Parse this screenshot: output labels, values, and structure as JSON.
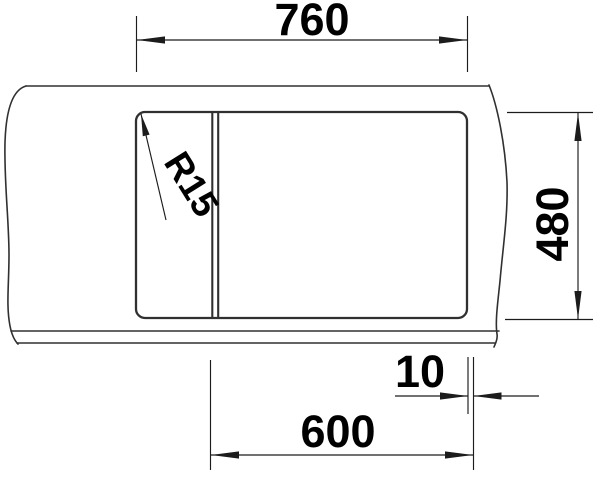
{
  "drawing": {
    "type": "technical-dimension-drawing",
    "subject": "sink cut-out top view with break lines",
    "labels": {
      "width_top": "760",
      "depth_right": "480",
      "cabinet_width": "600",
      "edge_offset": "10",
      "corner_radius": "R15"
    },
    "colors": {
      "background": "#ffffff",
      "outline": "#303030",
      "dimension": "#1c1c1c",
      "text": "#000000"
    }
  }
}
